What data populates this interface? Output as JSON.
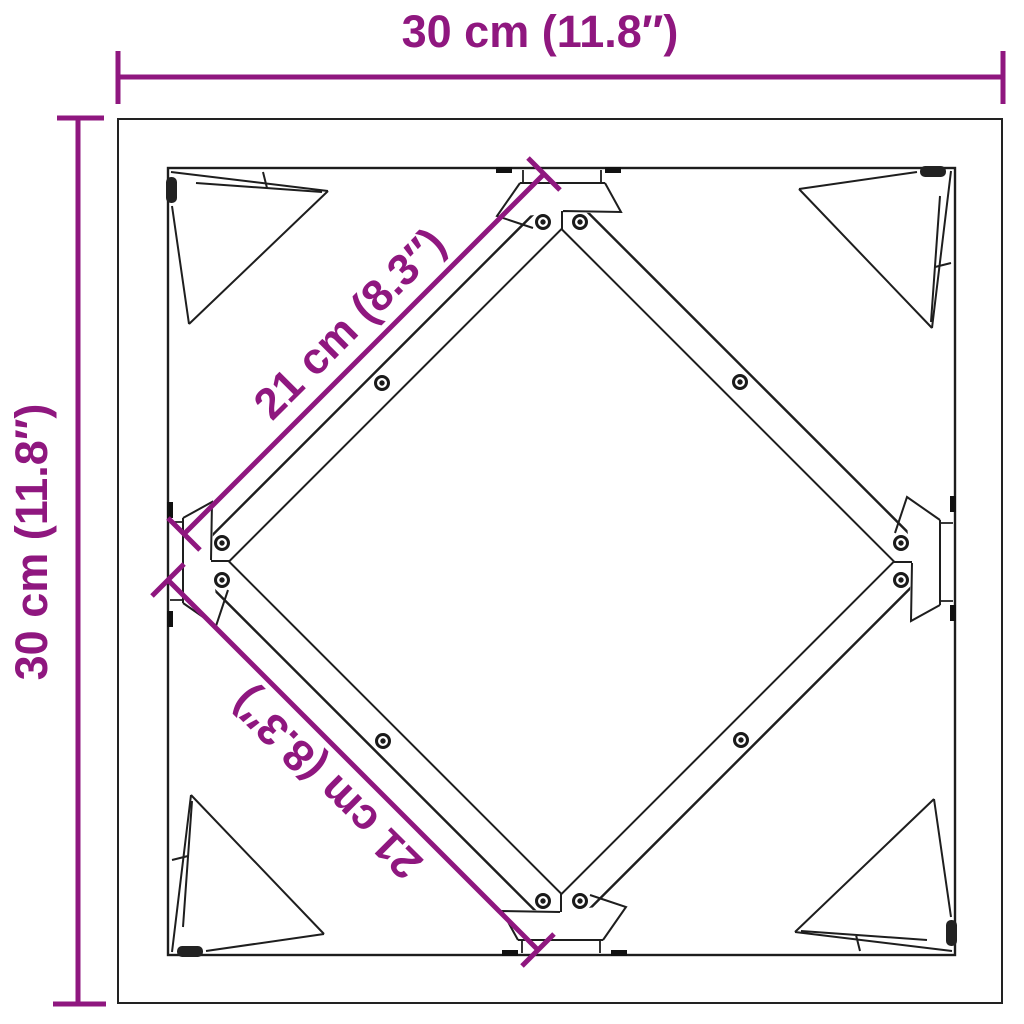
{
  "diagram": {
    "type": "product-dimension-diagram",
    "background_color": "#ffffff",
    "line_color": "#1e1e1e",
    "accent_color": "#8F177F",
    "labels": {
      "width": "30 cm (11.8″)",
      "height": "30 cm (11.8″)",
      "diagonal_top": "21 cm (8.3″)",
      "diagonal_bottom": "21 cm (8.3″)"
    },
    "dimensions": {
      "outer_width_cm": 30,
      "outer_width_in": 11.8,
      "outer_height_cm": 30,
      "outer_height_in": 11.8,
      "brace_length_cm": 21,
      "brace_length_in": 8.3
    }
  }
}
